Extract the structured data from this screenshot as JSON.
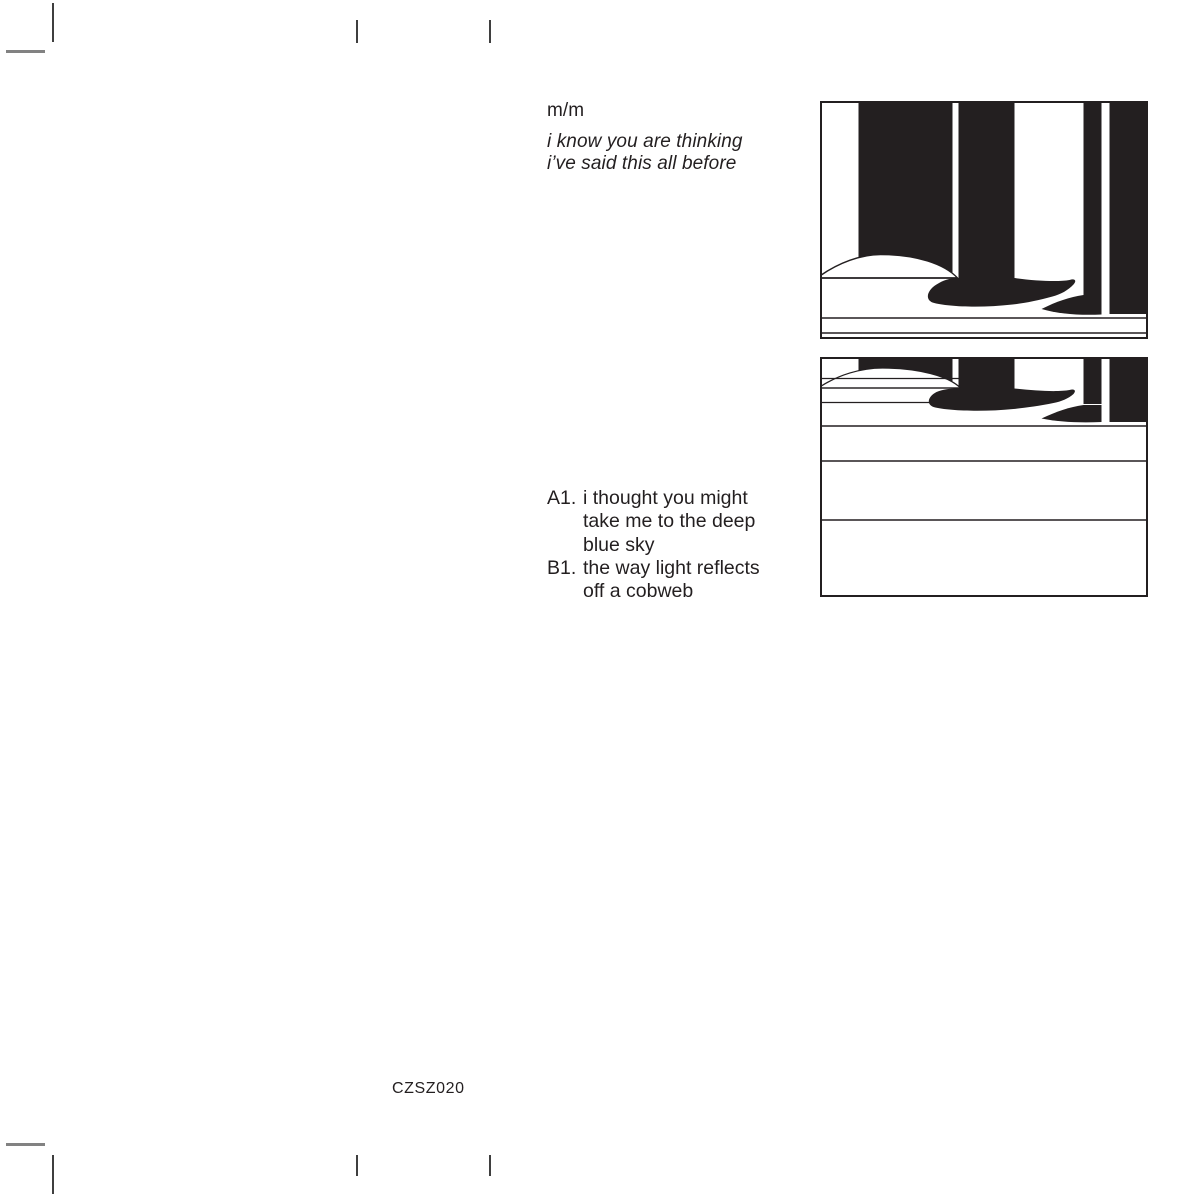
{
  "canvas": {
    "background": "#ffffff",
    "ink": "#231f20",
    "crop_mark_color": "#3f3f3f"
  },
  "release": {
    "artist": "m/m",
    "title_line1": "i know you are thinking",
    "title_line2": "i’ve said this all before",
    "catalog_number": "CZSZ020"
  },
  "tracklist": {
    "rows": [
      {
        "label": "A1.",
        "text": "i thought you might"
      },
      {
        "label": "",
        "text": "take me to the deep"
      },
      {
        "label": "",
        "text": "blue sky"
      },
      {
        "label": "B1.",
        "text": "the way light reflects"
      },
      {
        "label": "",
        "text": "off a cobweb"
      }
    ]
  },
  "artwork": {
    "front_cover": "abstract-black-bars-and-wave",
    "back_cover": "compressed-bars-wave-with-bands"
  }
}
